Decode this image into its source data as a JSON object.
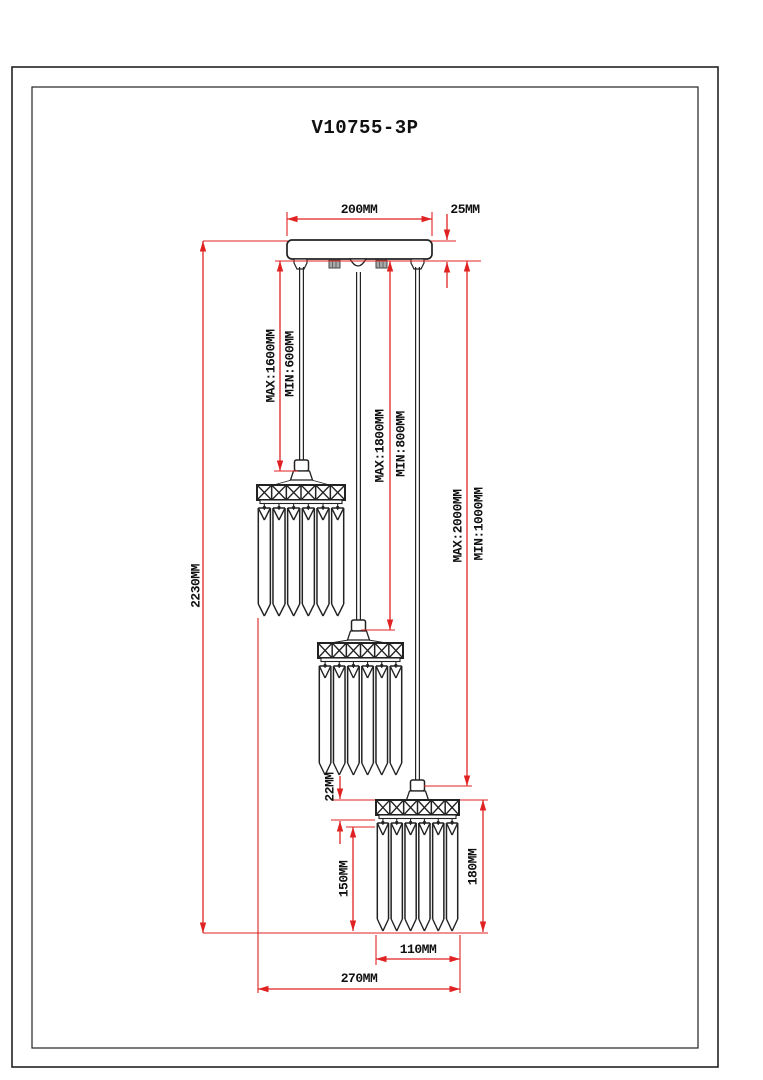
{
  "title": "V10755-3P",
  "colors": {
    "dimension_line": "#e02222",
    "drawing_line": "#222222",
    "background": "#ffffff"
  },
  "labels": {
    "canopy_width": "200MM",
    "canopy_thickness": "25MM",
    "total_height": "2230MM",
    "cord1_max": "MAX:1600MM",
    "cord1_min": "MIN:600MM",
    "cord2_max": "MAX:1800MM",
    "cord2_min": "MIN:800MM",
    "cord3_max": "MAX:2000MM",
    "cord3_min": "MIN:1000MM",
    "shade_band_height": "22MM",
    "shade_crystal_height": "150MM",
    "shade_total_height": "180MM",
    "shade_width": "110MM",
    "fixture_width": "270MM"
  }
}
